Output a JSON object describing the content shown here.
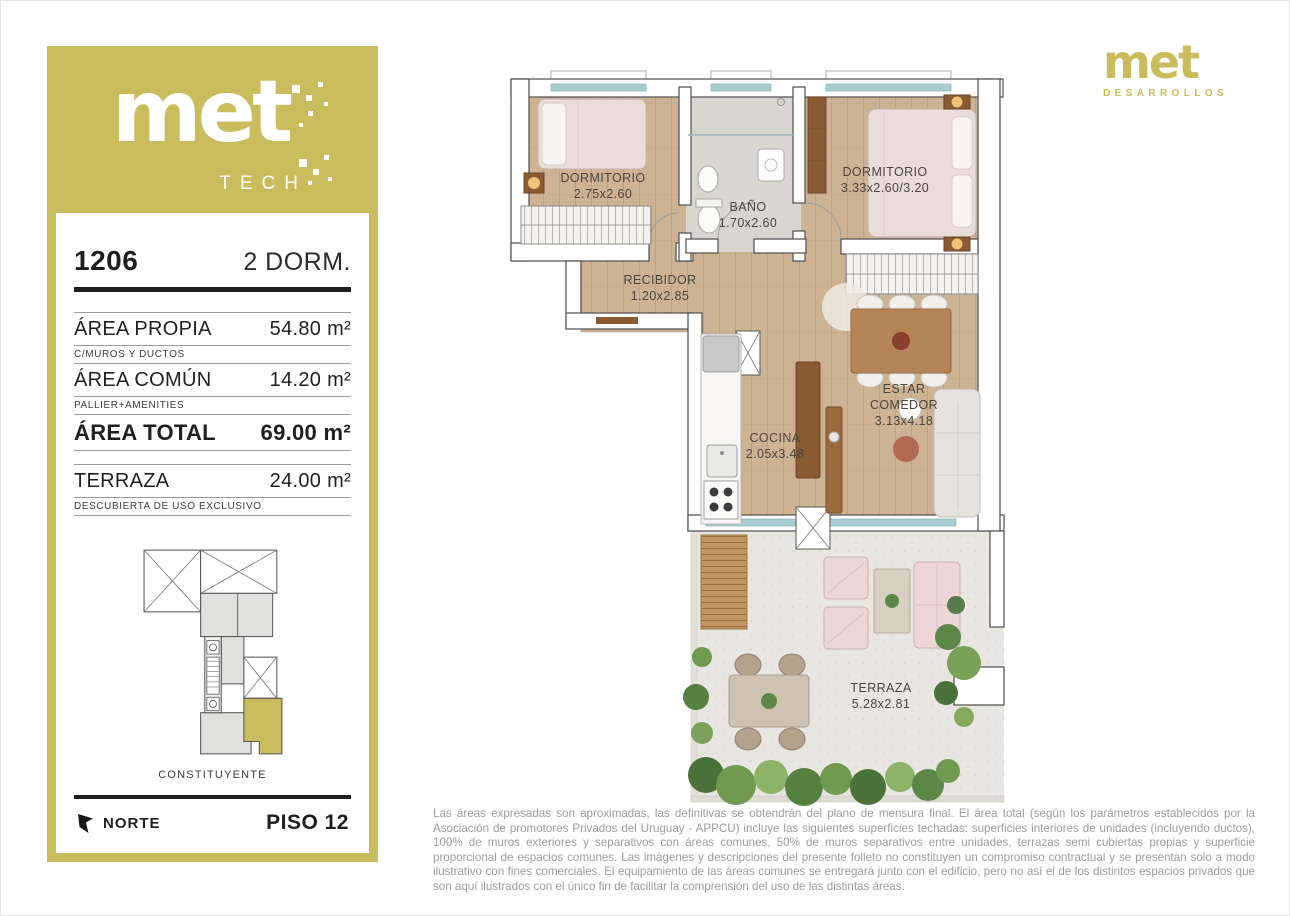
{
  "sidebar": {
    "logo": {
      "brand": "met",
      "sub": "TECH"
    },
    "unit": {
      "number": "1206",
      "type": "2 DORM."
    },
    "areas": [
      {
        "label": "ÁREA PROPIA",
        "value": "54.80 m²",
        "caption": "C/MUROS Y DUCTOS"
      },
      {
        "label": "ÁREA COMÚN",
        "value": "14.20 m²",
        "caption": "PALLIER+AMENITIES"
      },
      {
        "label": "ÁREA TOTAL",
        "value": "69.00 m²",
        "caption": ""
      },
      {
        "label": "TERRAZA",
        "value": "24.00 m²",
        "caption": "DESCUBIERTA DE USO EXCLUSIVO"
      }
    ],
    "street_label": "CONSTITUYENTE",
    "north_label": "NORTE",
    "floor_label": "PISO 12"
  },
  "header_logo": {
    "brand": "met",
    "sub": "DESARROLLOS"
  },
  "floorplan": {
    "rooms": [
      {
        "name": "DORMITORIO",
        "dims": "2.75x2.60"
      },
      {
        "name": "BAÑO",
        "dims": "1.70x2.60"
      },
      {
        "name": "DORMITORIO",
        "dims": "3.33x2.60/3.20"
      },
      {
        "name": "RECIBIDOR",
        "dims": "1.20x2.85"
      },
      {
        "name": "COCINA",
        "dims": "2.05x3.48"
      },
      {
        "name": "ESTAR",
        "name2": "COMEDOR",
        "dims": "3.13x4.18"
      },
      {
        "name": "TERRAZA",
        "dims": "5.28x2.81"
      }
    ]
  },
  "disclaimer": "Las áreas expresadas son aproximadas, las definitivas se obtendrán del plano de mensura final. El área total (según los parámetros establecidos por la Asociación de promotores Privados del Uruguay - APPCU) incluye las siguientes superficies techadas: superficies interiores de unidades (incluyendo ductos), 100% de muros exteriores y separativos con áreas comunes, 50% de muros separativos entre unidades, terrazas semi cubiertas propias y superficie proporcional de espacios comunes.  Las imágenes y descripciones del presente folleto no constituyen un compromiso contractual y se presentan solo a modo ilustrativo con fines comerciales. El equipamiento de las áreas comunes se entregará junto con el edificio, pero no así el de los distintos espacios privados que son aquí ilustrados con el único fin de facilitar la comprensión del uso de las distintas áreas.",
  "colors": {
    "brand_gold": "#c9bc5c",
    "wood_floor": "#cdb394",
    "bath_tile": "#d9d6d0",
    "terrace_floor": "#e8e6e0",
    "glass": "#a9cdd1",
    "text_dark": "#1d1d1d",
    "text_muted": "#9c9c9c"
  }
}
